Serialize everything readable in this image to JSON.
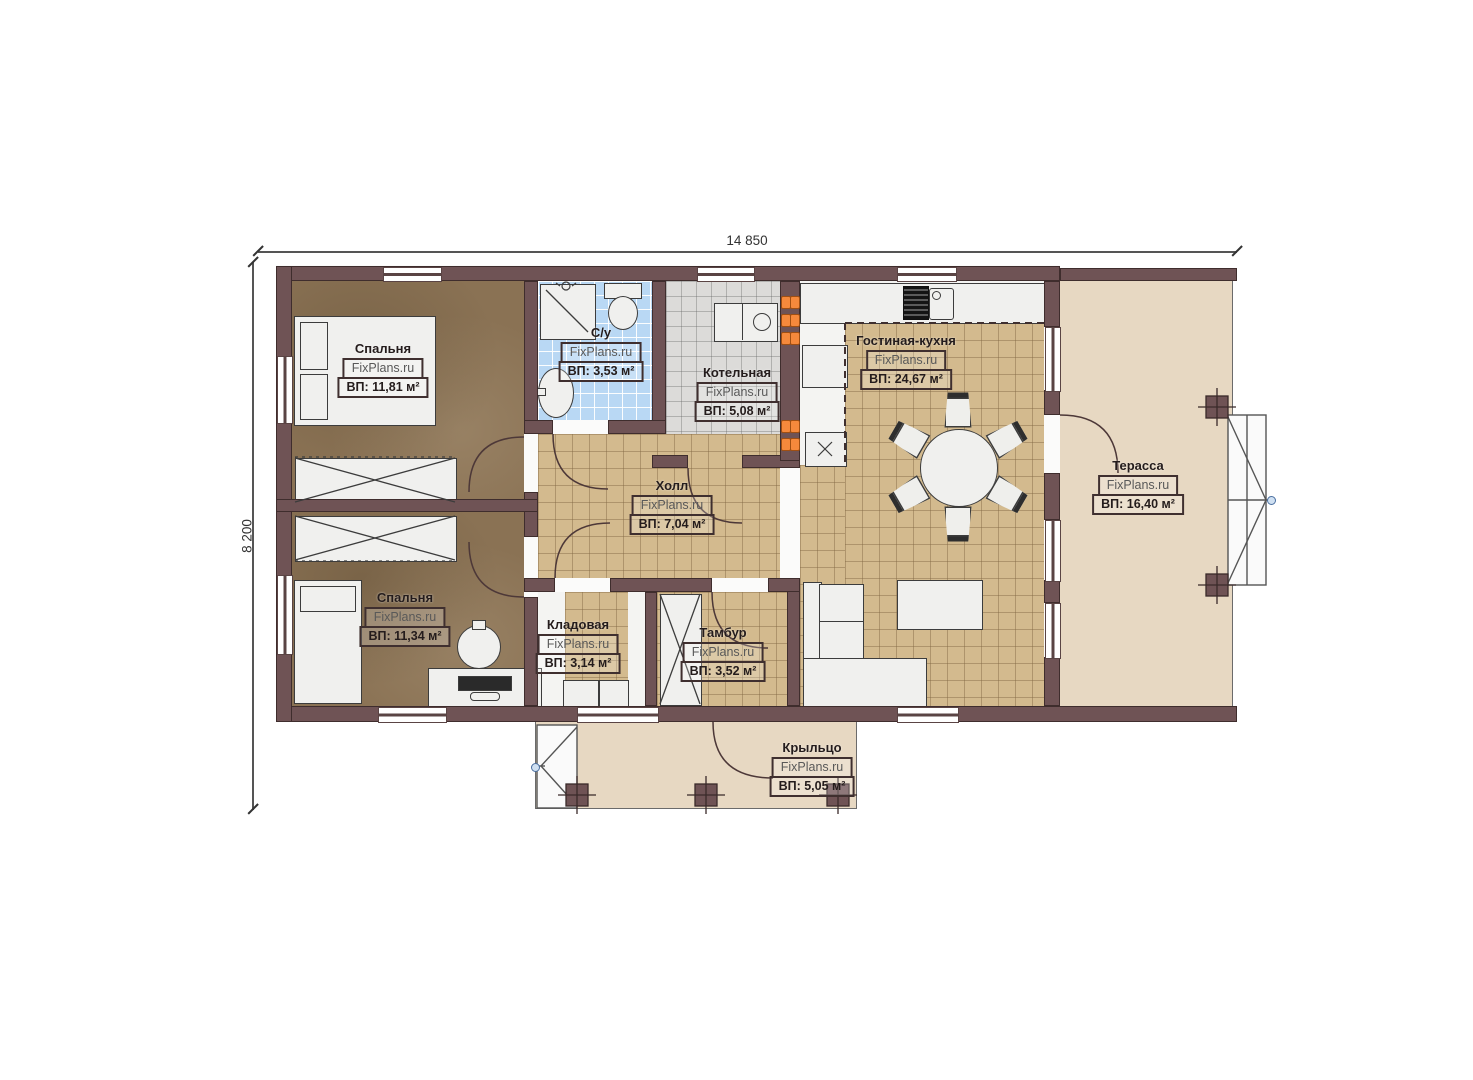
{
  "meta": {
    "watermark": "FixPlans.ru"
  },
  "plan_dimensions": {
    "width_label": "14 850",
    "height_label": "8 200"
  },
  "rooms": [
    {
      "id": "bedroom1",
      "name": "Спальня",
      "area": "ВП: 11,81 м²"
    },
    {
      "id": "bathroom",
      "name": "С/у",
      "area": "ВП: 3,53 м²"
    },
    {
      "id": "boiler",
      "name": "Котельная",
      "area": "ВП: 5,08 м²"
    },
    {
      "id": "living",
      "name": "Гостиная-кухня",
      "area": "ВП: 24,67 м²"
    },
    {
      "id": "terrace",
      "name": "Терасса",
      "area": "ВП: 16,40 м²"
    },
    {
      "id": "hall",
      "name": "Холл",
      "area": "ВП: 7,04 м²"
    },
    {
      "id": "bedroom2",
      "name": "Спальня",
      "area": "ВП: 11,34 м²"
    },
    {
      "id": "storage",
      "name": "Кладовая",
      "area": "ВП: 3,14 м²"
    },
    {
      "id": "tambour",
      "name": "Тамбур",
      "area": "ВП: 3,52 м²"
    },
    {
      "id": "porch",
      "name": "Крыльцо",
      "area": "ВП: 5,05 м²"
    }
  ],
  "colors": {
    "wall": "#6f5355",
    "floor_bedroom": "#8a7254",
    "floor_tile_tan": "#d3ba8e",
    "floor_tile_blue": "#b9d8f4",
    "floor_tile_gray": "#dcdbd9",
    "floor_outdoor": "#e7d8c2",
    "outlet_accent": "#f5893c"
  }
}
